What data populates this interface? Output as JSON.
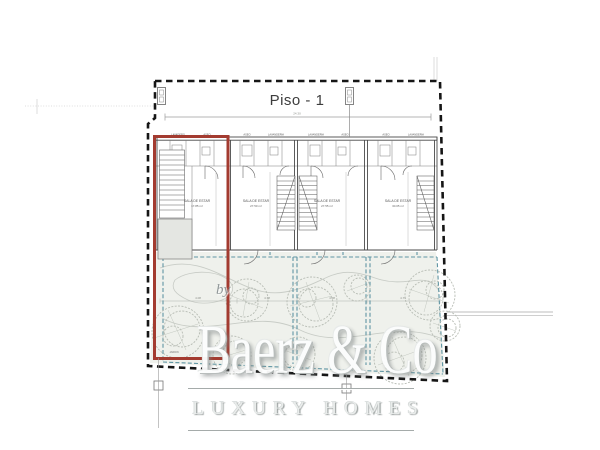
{
  "plan": {
    "title": "Piso - 1",
    "overall_dim": "24.30",
    "units": [
      {
        "room_label": "SALA DE ESTAR",
        "room_area": "17.85 m²"
      },
      {
        "room_label": "SALA DE ESTAR",
        "room_area": "27.50 m²"
      },
      {
        "room_label": "SALA DE ESTAR",
        "room_area": "27.55 m²"
      },
      {
        "room_label": "SALA DE ESTAR",
        "room_area": "30.05 m²"
      }
    ],
    "service_rooms": [
      "LAVADERO",
      "ASEO",
      "ASEO",
      "LAVANDERIA",
      "LAVANDERIA",
      "ASEO",
      "ASEO",
      "LAVANDERIA"
    ],
    "garden_label": "JARDIN",
    "garden_dims": [
      "4.08",
      "4.38",
      "4.08",
      "4.75"
    ],
    "colors": {
      "highlight_red": "#a33b30",
      "terrace_teal": "#5f95a3",
      "boundary_black": "#161616",
      "garden_fill": "#eff1ec"
    }
  },
  "watermark": {
    "by": "by",
    "brand": "Baerz & Co",
    "tagline": "LUXURY HOMES"
  }
}
